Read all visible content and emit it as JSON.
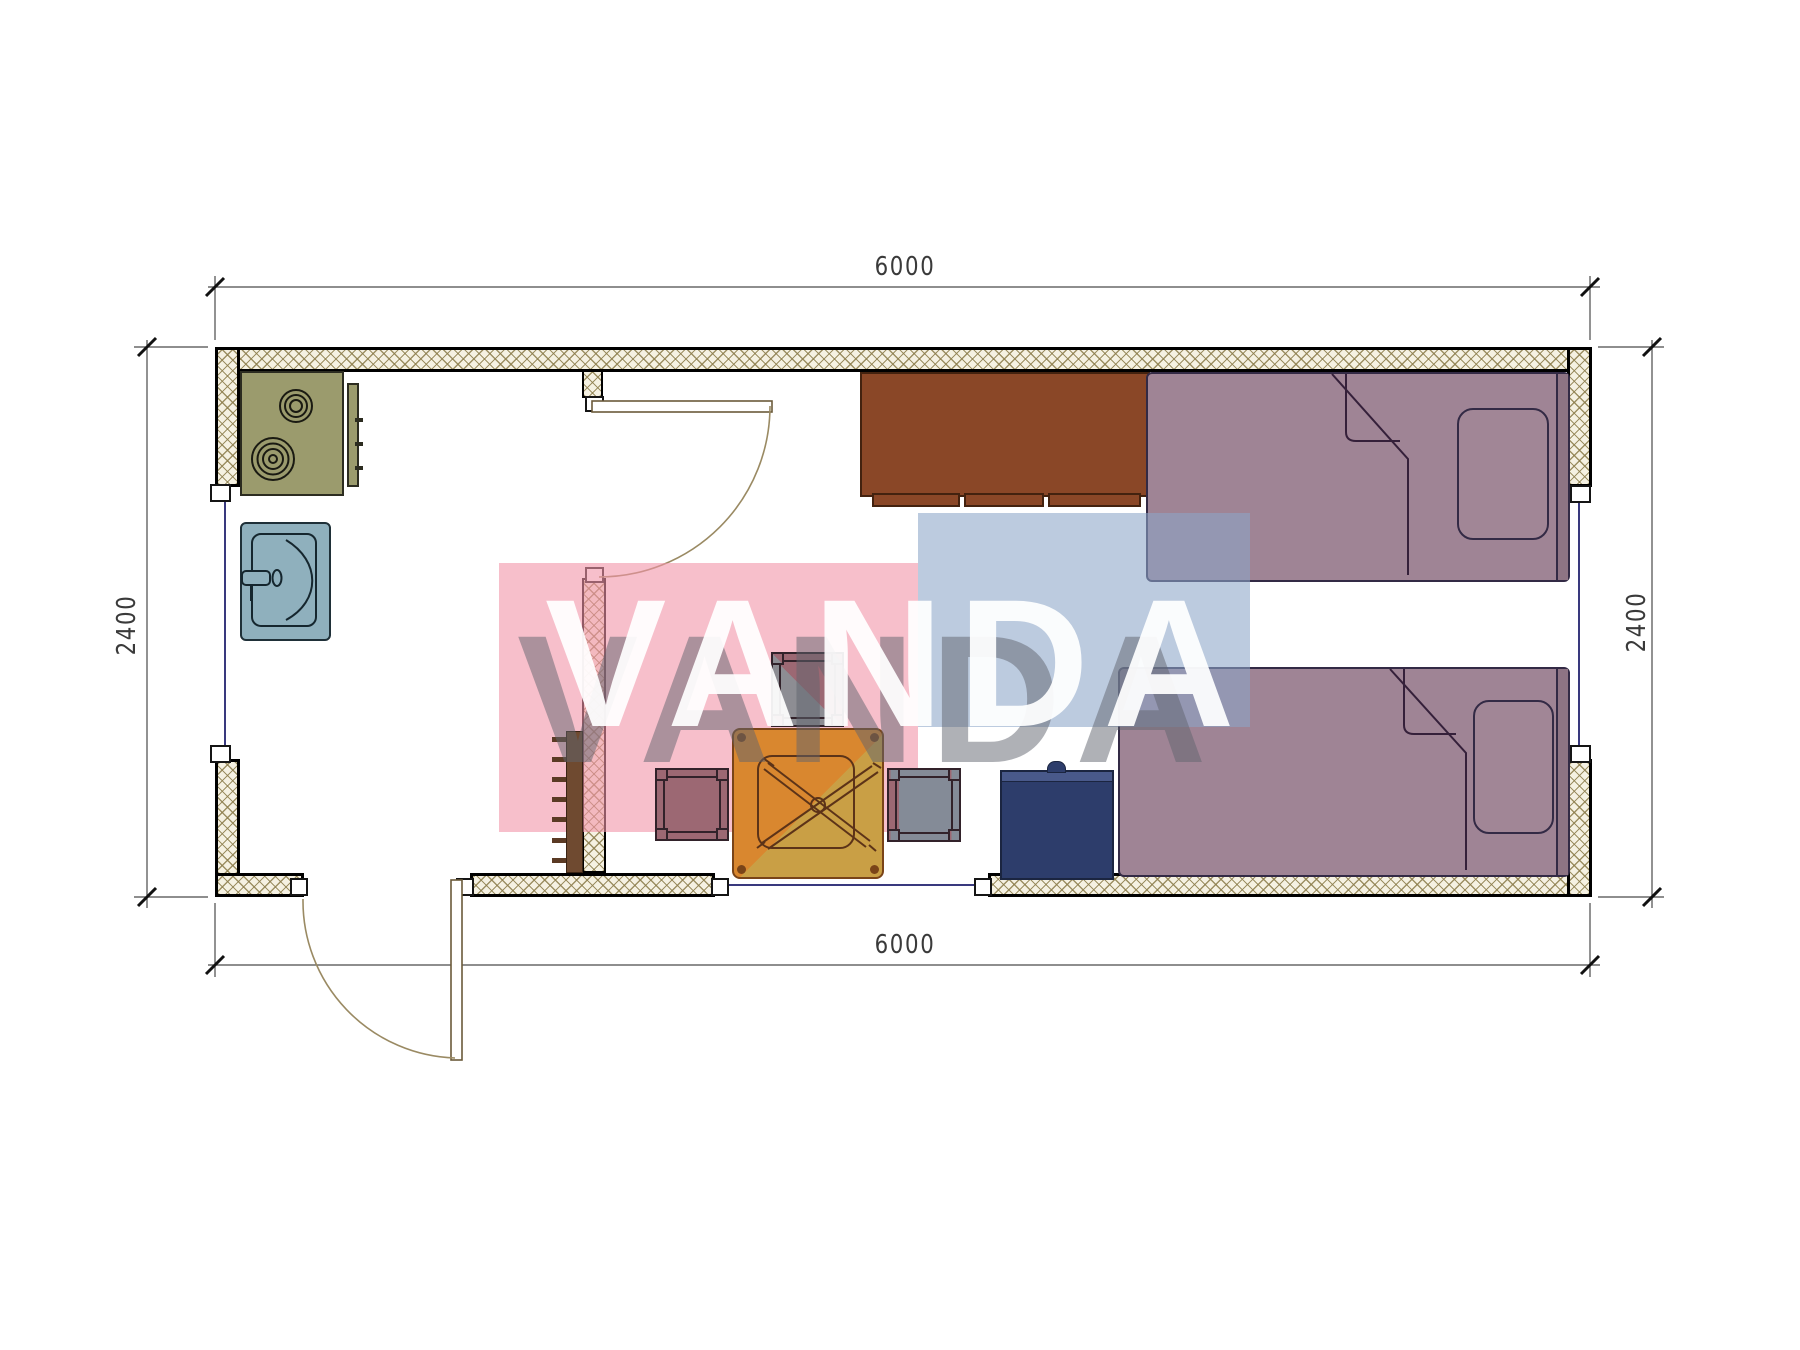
{
  "plan": {
    "type": "container-house-floor-plan",
    "width_label_top": "6000",
    "width_label_bottom": "6000",
    "height_label_left": "2400",
    "height_label_right": "2400"
  },
  "dimensions": {
    "top": "6000",
    "bottom": "6000",
    "left": "2400",
    "right": "2400"
  },
  "watermark": {
    "text": "VANDA",
    "pink": "#f1a0b0",
    "blue": "#8ca5c9"
  },
  "palette": {
    "wall_hatch_bg": "#f5f1e2",
    "wall_hatch_line": "#8d7e4d",
    "stove": "#9b9b6d",
    "sink": "#8fb0bd",
    "cabinet": "#8a4727",
    "bed": "#9f8495",
    "table_orange": "#d9872f",
    "table_gold": "#c99f45",
    "stool": "#9c6873",
    "stool_shaded": "#848b97",
    "nightstand": "#2d3d6b",
    "window_line": "#39397e"
  }
}
